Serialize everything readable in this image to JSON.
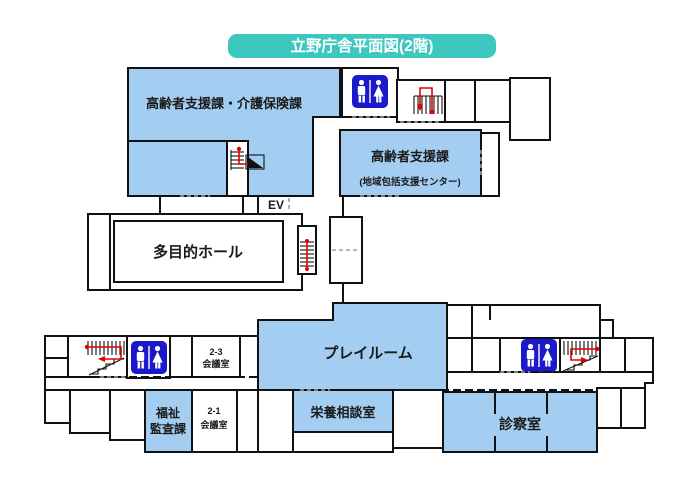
{
  "title": {
    "text": "立野庁舎平面図(2階)"
  },
  "colors": {
    "room_fill": "#A3CEF2",
    "toilet_blue": "#1A1ACC",
    "title_bg": "#3CC7BF",
    "title_text": "#FFFFFF",
    "wall": "#111111",
    "route_red": "#E60000",
    "door_gray": "#9AA0A6"
  },
  "labels": {
    "elevator": "EV"
  },
  "rooms": {
    "elderly_care_insurance": {
      "label": "高齢者支援課・介護保険課"
    },
    "elderly_support": {
      "label": "高齢者支援課",
      "sublabel": "(地域包括支援センター)"
    },
    "multipurpose_hall": {
      "label": "多目的ホール"
    },
    "playroom": {
      "label": "プレイルーム"
    },
    "meeting_2_3": {
      "line1": "2-3",
      "line2": "会議室"
    },
    "welfare_audit": {
      "line1": "福祉",
      "line2": "監査課"
    },
    "meeting_2_1": {
      "line1": "2-1",
      "line2": "会議室"
    },
    "nutrition": {
      "label": "栄養相談室"
    },
    "exam": {
      "label": "診察室"
    }
  },
  "icons": {
    "toilet": "restroom-pictogram",
    "stairs": "staircase-with-route",
    "route": "red-evacuation-route"
  }
}
